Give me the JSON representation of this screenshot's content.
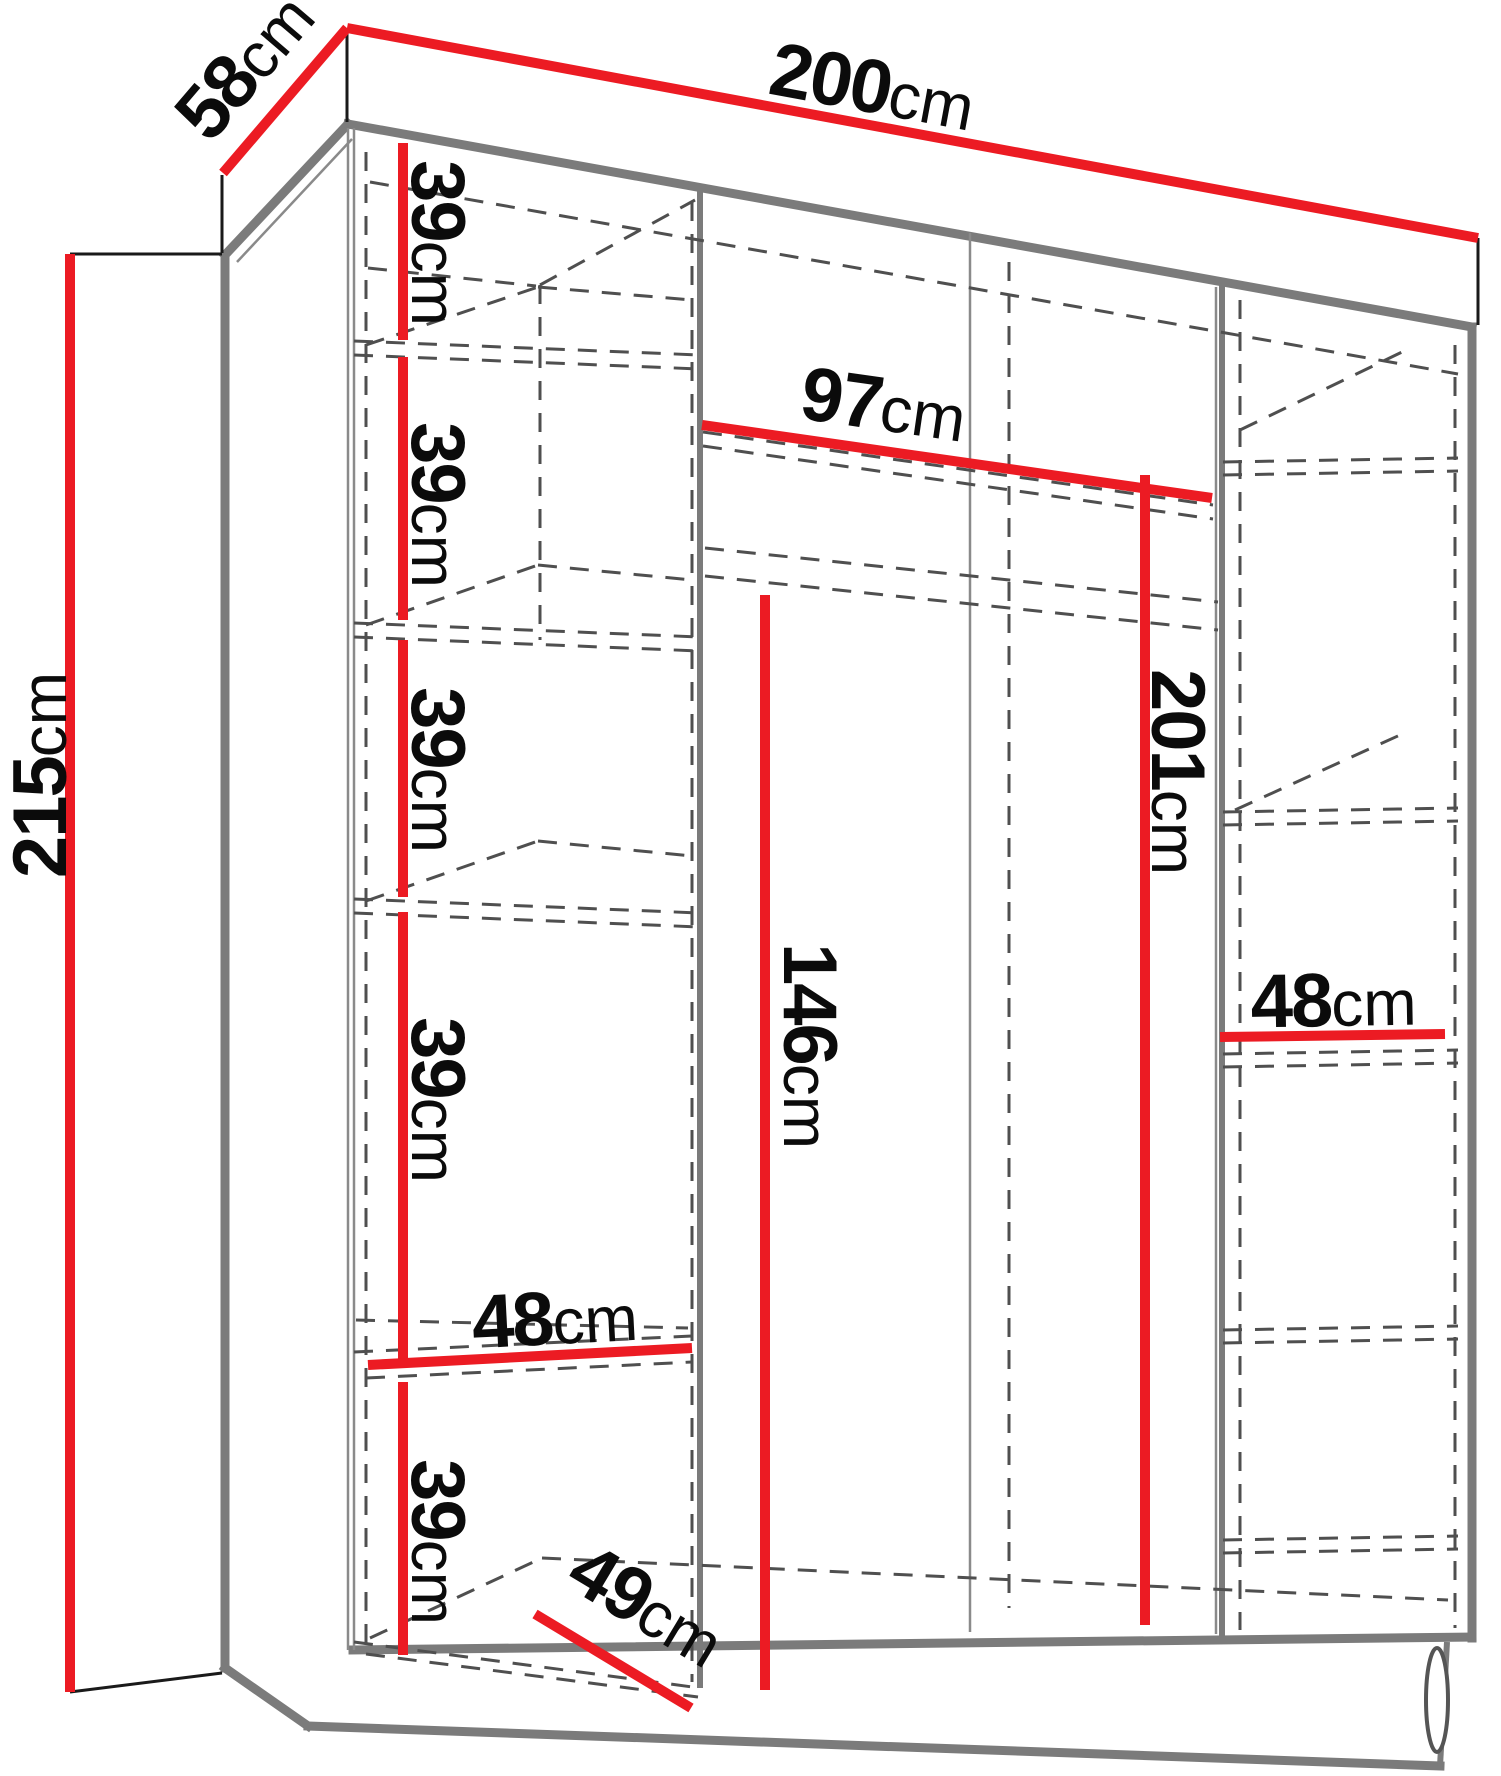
{
  "diagram": {
    "unit": "cm",
    "colors": {
      "dimension_line": "#ec1b23",
      "structure": "#7b7b7b",
      "hidden_line": "#4f4f4f",
      "label": "#0b0b0b",
      "background": "#ffffff"
    },
    "labels": {
      "width": {
        "value": "200",
        "unit": "cm"
      },
      "depth": {
        "value": "58",
        "unit": "cm"
      },
      "height": {
        "value": "215",
        "unit": "cm"
      },
      "shelf_gap_1": {
        "value": "39",
        "unit": "cm"
      },
      "shelf_gap_2": {
        "value": "39",
        "unit": "cm"
      },
      "shelf_gap_3": {
        "value": "39",
        "unit": "cm"
      },
      "shelf_gap_4": {
        "value": "39",
        "unit": "cm"
      },
      "shelf_gap_5": {
        "value": "39",
        "unit": "cm"
      },
      "hanging_width": {
        "value": "97",
        "unit": "cm"
      },
      "interior_height": {
        "value": "201",
        "unit": "cm"
      },
      "hanging_height": {
        "value": "146",
        "unit": "cm"
      },
      "left_shelf_width": {
        "value": "48",
        "unit": "cm"
      },
      "right_shelf_width": {
        "value": "48",
        "unit": "cm"
      },
      "shelf_depth": {
        "value": "49",
        "unit": "cm"
      }
    }
  }
}
